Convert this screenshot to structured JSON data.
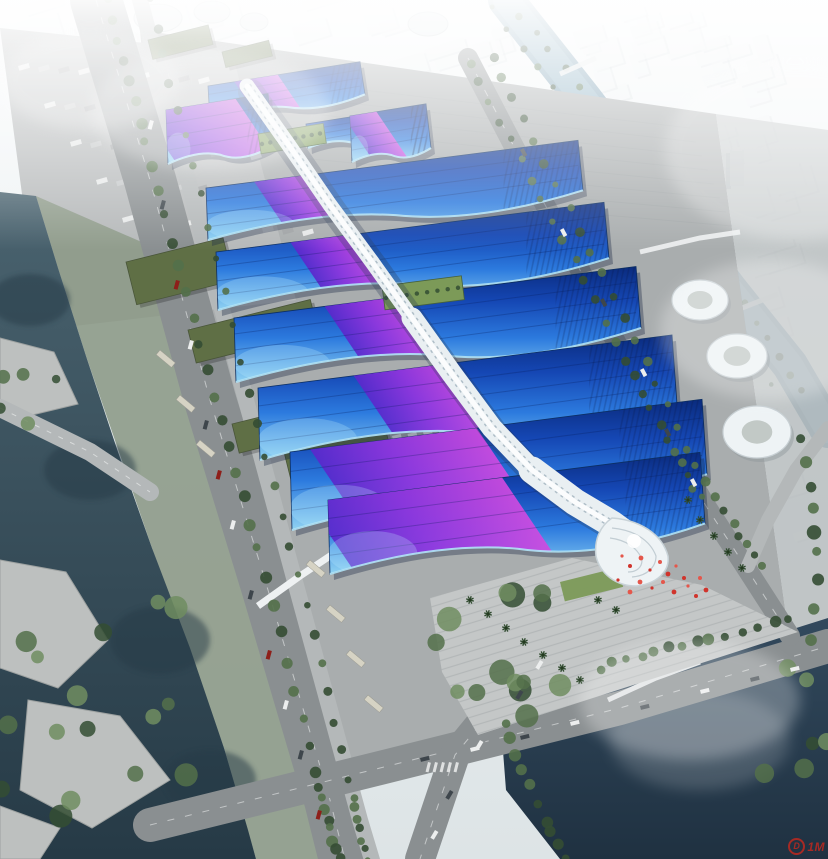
{
  "watermark": {
    "logo": "D",
    "text": "1M"
  },
  "colors": {
    "sky_top": "#f5f8f9",
    "sky_bottom": "#dde4e6",
    "haze": "#ffffff",
    "city_block": "#eff3f4",
    "city_shadow": "#c3ccd0",
    "tower_face": "#dde4e7",
    "tower_side": "#b2bcc2",
    "ground": "#a9adae",
    "parking": "#b6b9ba",
    "yard": "#a3a7a7",
    "road": "#8a8f91",
    "road_light": "#b4b8b9",
    "lane": "#f2f4f4",
    "water_left": "#4a636f",
    "water_left_deep": "#263a46",
    "pond": "#32495d",
    "pond_deep": "#1f3141",
    "river_haze": "#90b3c5",
    "bank_green": "#8d9a88",
    "tree_dark": "#344d33",
    "tree_mid": "#53704a",
    "tree_light": "#708d60",
    "lawn": "#7c9a58",
    "green_roof": "#5f6f45",
    "roof_navy": "#0a2b7e",
    "roof_deep": "#1547b4",
    "roof_mid": "#2c7ade",
    "roof_light": "#8fd2f2",
    "roof_rim": "#b5e7f8",
    "ribbon_violet": "#5a28cc",
    "ribbon_purple": "#9334de",
    "ribbon_magenta": "#cf4ae0",
    "spine_white": "#e9eff2",
    "spine_shadow": "#9fb0bc",
    "shell_white": "#eef3f5",
    "plaza": "#c4c7c7",
    "plaza_line": "#9aa0a1",
    "terrace": "#bdc0bf",
    "red_accent": "#d0342c",
    "watermark_red": "#c8281d",
    "car_dark": "#3e464c",
    "car_white": "#eceeee",
    "bus": "#d6d3c4"
  }
}
